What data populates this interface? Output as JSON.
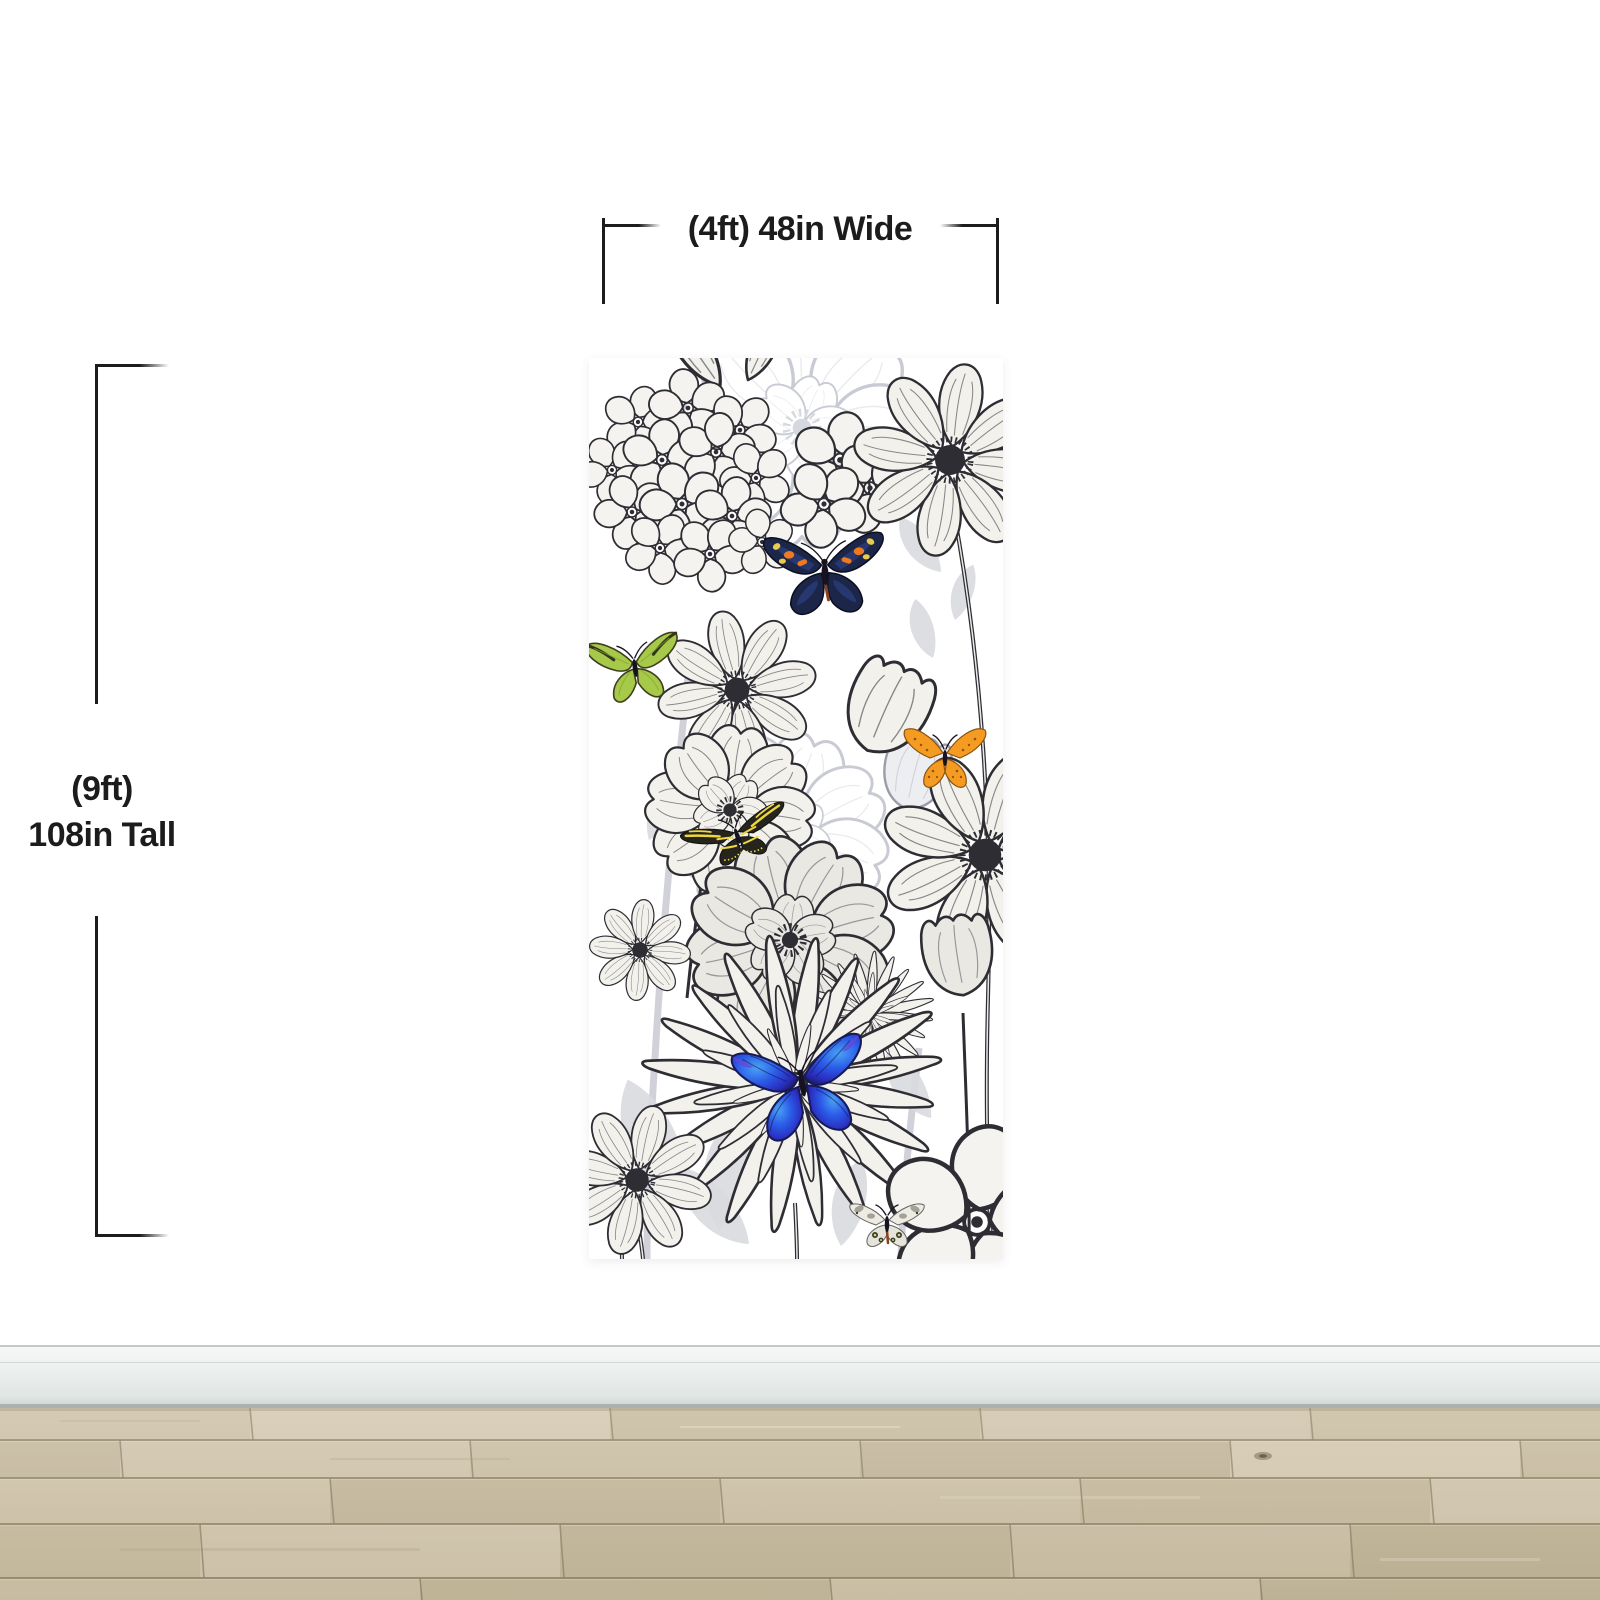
{
  "annotations": {
    "width": {
      "label": "(4ft) 48in Wide"
    },
    "height": {
      "line1": "(9ft)",
      "line2": "108in Tall"
    }
  },
  "mural": {
    "butterflies": [
      "navy-black with orange and yellow spots",
      "lime green",
      "orange speckled",
      "black with yellow zebra stripes",
      "blue morpho",
      "pale apollo with eye spots"
    ]
  },
  "colors": {
    "text": "#1c1c1c",
    "dimension_line": "#1c1c1c",
    "wall": "#ffffff",
    "panel_bg": "#ffffff",
    "ink": "#2e2d33",
    "ink_light": "#c9cad2",
    "baseboard_light": "#f5f7f6",
    "baseboard_dark": "#e0e4e3",
    "baseboard_edge": "#c3c9c8",
    "baseboard_shadow": "#abb1af",
    "floor_base": "#cfc3a9",
    "floor_light": "#dccfb7",
    "floor_dark": "#c2b69b",
    "floor_gap": "#8d8166",
    "butterfly_navy": "#1c2648",
    "butterfly_navy_edge": "#0b0f1f",
    "spot_orange": "#f0791f",
    "spot_yellow": "#e9cb4e",
    "tail_brown": "#8a4020",
    "butterfly_green": "#a6c949",
    "butterfly_green_dark": "#3f3f1f",
    "butterfly_orange": "#f59b22",
    "butterfly_orange_dark": "#8a5410",
    "zebra_black": "#26251d",
    "zebra_yellow": "#ecd53e",
    "morpho_core": "#4aa2f5",
    "morpho_mid": "#2b5be8",
    "morpho_deep": "#2a2cbe",
    "morpho_edge": "#171a56",
    "apollo_wing": "#edebe2",
    "apollo_patch": "#8f8f88",
    "apollo_spot": "#3a3a35",
    "apollo_eye": "#d9d94e"
  }
}
